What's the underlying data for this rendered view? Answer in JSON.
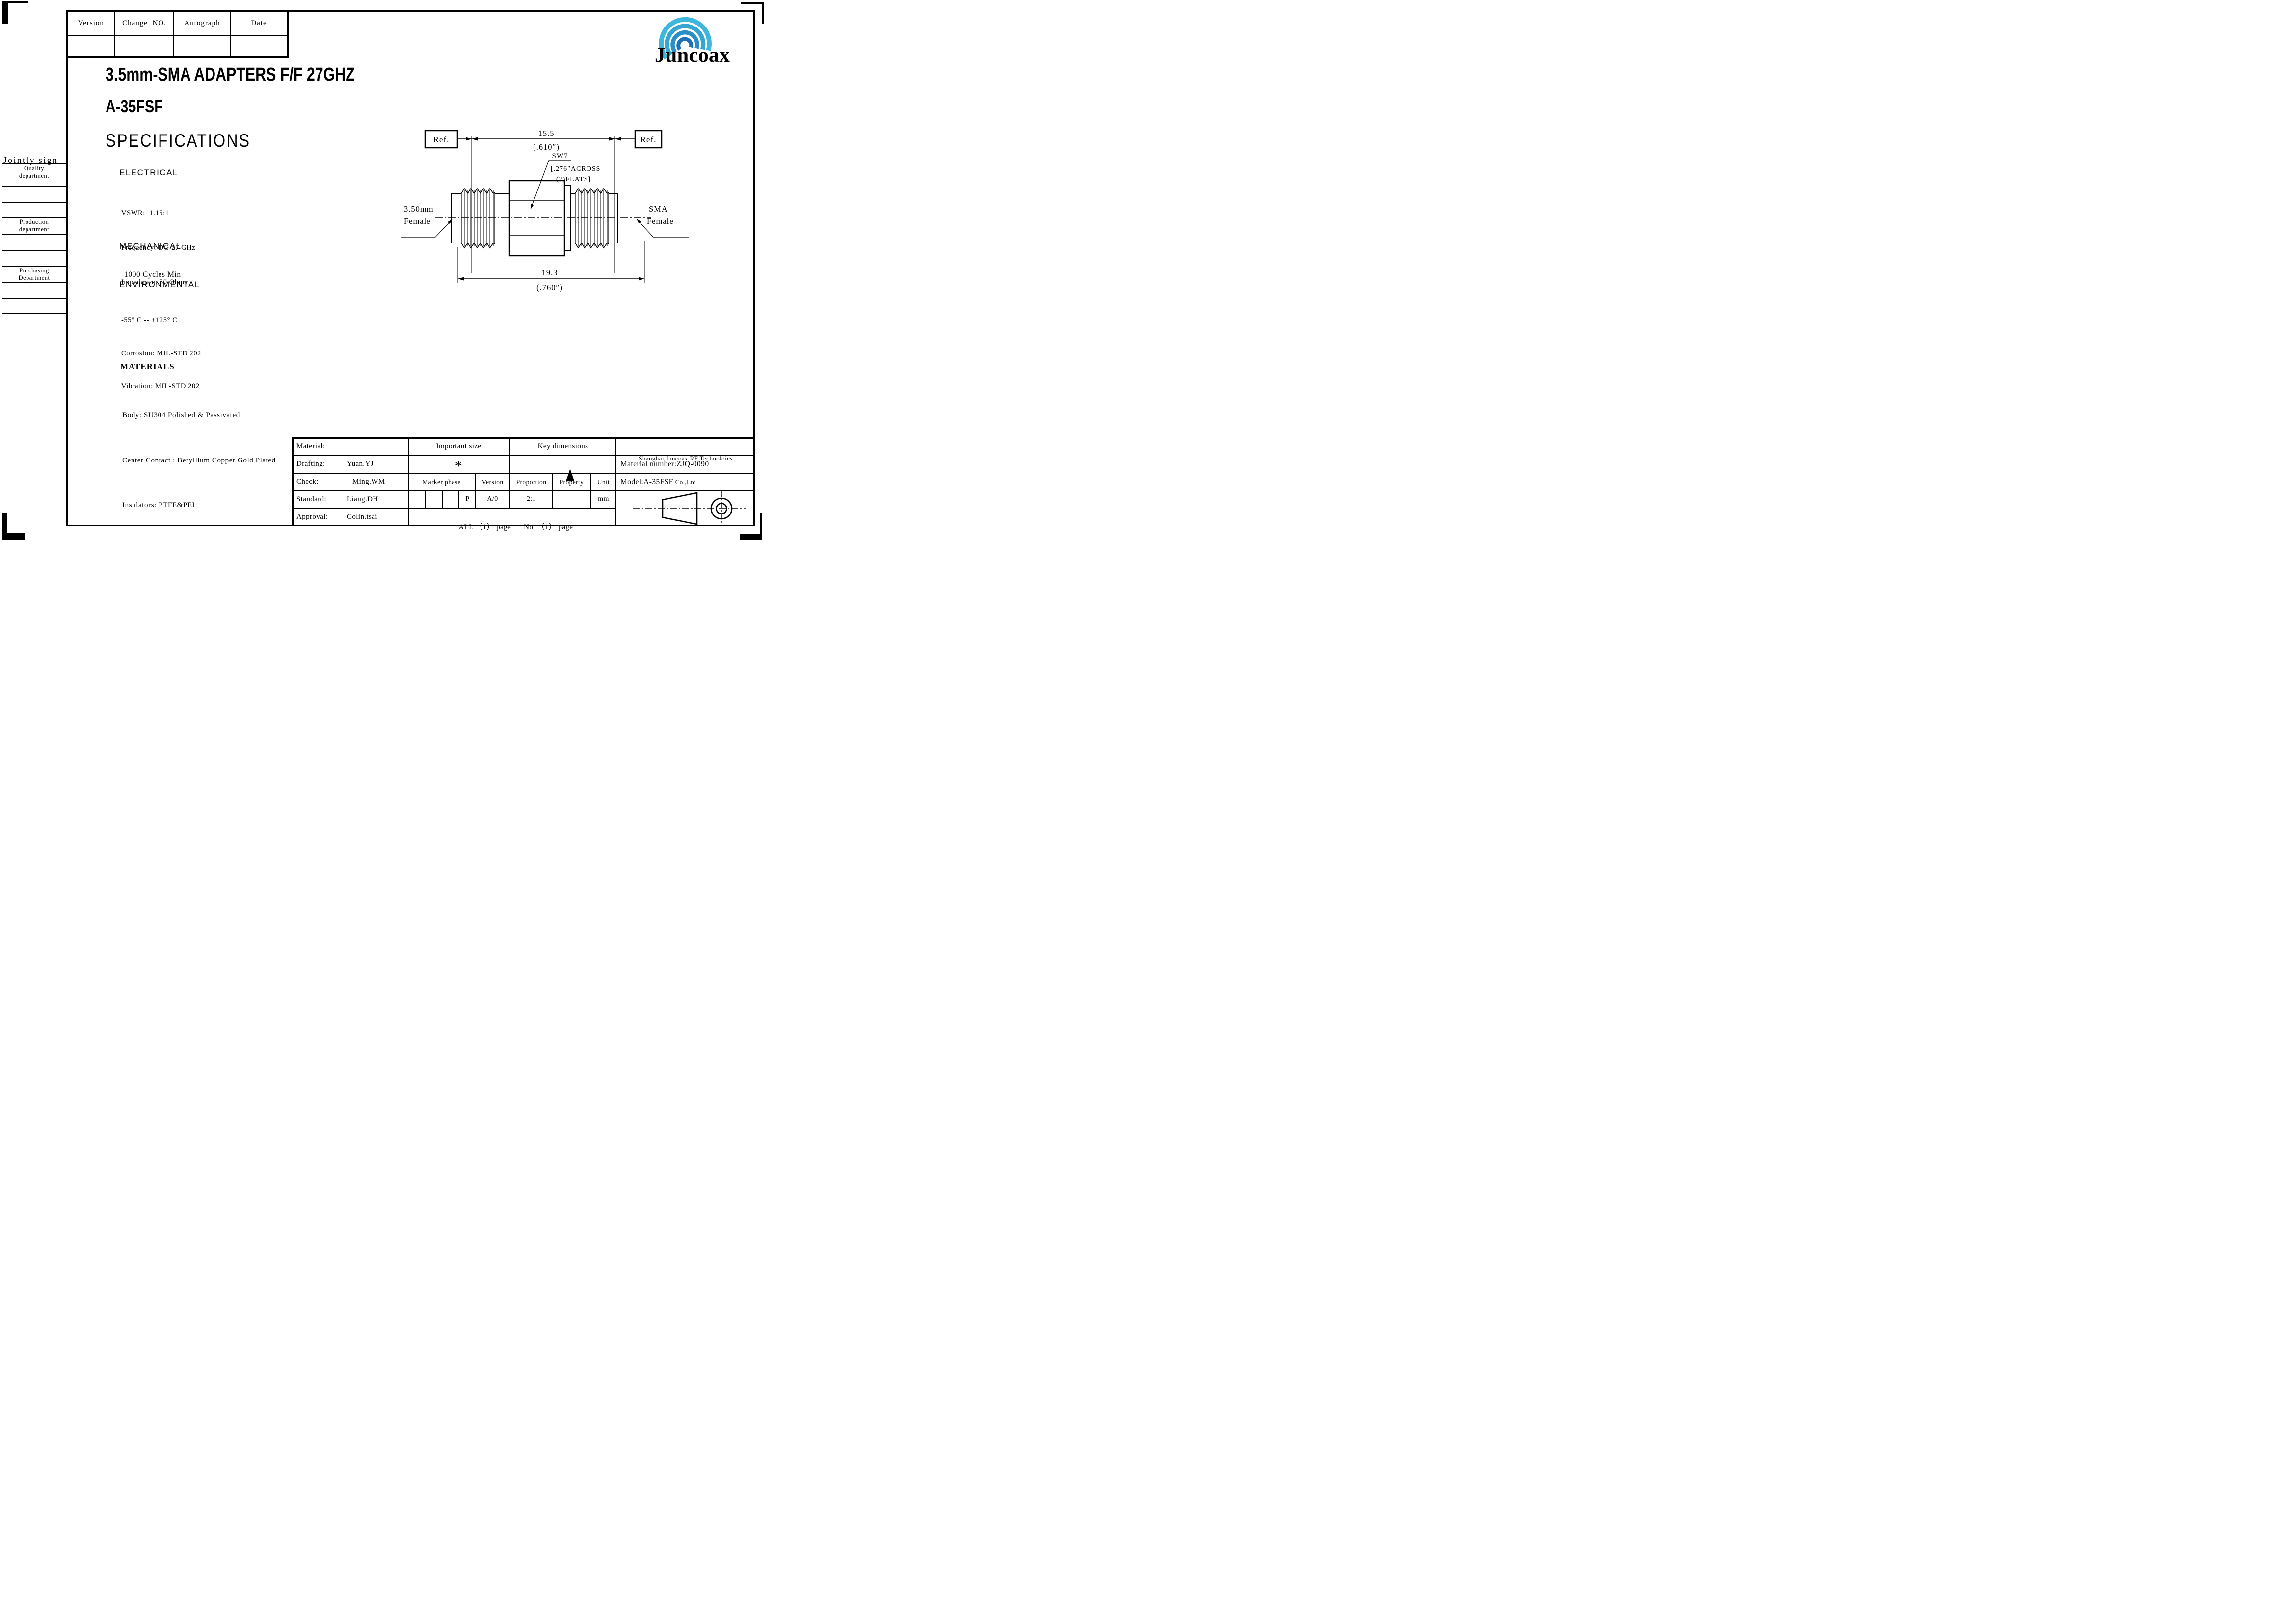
{
  "colors": {
    "logo_blue": "#1b67b8",
    "logo_teal_outer": "#3fb7dc",
    "ink": "#000000"
  },
  "revision_table": {
    "headers": [
      "Version",
      "Change  NO.",
      "Autograph",
      "Date"
    ]
  },
  "logo": {
    "text": "Juncoax"
  },
  "titles": {
    "product": "3.5mm-SMA ADAPTERS F/F 27GHZ",
    "model": "A-35FSF",
    "section": "SPECIFICATIONS"
  },
  "jointly_sign": {
    "title": "Jointly sign",
    "quality_line1": "Quality",
    "quality_line2": "department",
    "production_line1": "Production",
    "production_line2": "department",
    "purchasing_line1": "Purchasing",
    "purchasing_line2": "Department"
  },
  "specs": {
    "electrical": {
      "heading": "ELECTRICAL",
      "lines": [
        "VSWR:  1.15:1",
        "Frequency: DC-27 GHz",
        "Impedance: 50 Ohms"
      ]
    },
    "mechanical": {
      "heading": "MECHANICAL",
      "lines": [
        "1000 Cycles Min"
      ]
    },
    "environmental": {
      "heading": "ENVIRONMENTAL",
      "lines": [
        "-55° C -- +125° C",
        "Corrosion: MIL-STD 202",
        "Vibration: MIL-STD 202"
      ]
    },
    "materials": {
      "heading": "MATERIALS",
      "lines": [
        "Body: SU304 Polished & Passivated",
        "Center Contact : Beryllium Copper Gold Plated",
        "Insulators: PTFE&PEI"
      ]
    }
  },
  "drawing": {
    "ref_left": "Ref.",
    "ref_right": "Ref.",
    "dim_body": {
      "value": "15.5",
      "inches": "(.610″)"
    },
    "dim_overall": {
      "value": "19.3",
      "inches": "(.760″)"
    },
    "wrench": {
      "label": "SW7",
      "note1": "[.276″ACROSS",
      "note2": "(2)FLATS]"
    },
    "left_port": {
      "line1": "3.50mm",
      "line2": "Female"
    },
    "right_port": {
      "line1": "SMA",
      "line2": "Female"
    }
  },
  "title_block": {
    "material_label": "Material:",
    "drafting_label": "Drafting:",
    "drafting_value": "Yuan.YJ",
    "check_label": "Check:",
    "check_value": "Ming.WM",
    "standard_label": "Standard:",
    "standard_value": "Liang.DH",
    "approval_label": "Approval:",
    "approval_value": "Colin.tsai",
    "important_size": "Important size",
    "important_size_symbol": "*",
    "key_dimensions": "Key dimensions",
    "key_dimensions_symbol": "▲",
    "marker_phase": "Marker phase",
    "version": "Version",
    "proportion": "Proportion",
    "property": "Property",
    "unit": "Unit",
    "marker_value": "P",
    "version_value": "A/0",
    "proportion_value": "2:1",
    "property_value": "",
    "unit_value": "mm",
    "pages_all": "ALL （1） page",
    "pages_no": "No. （1） page",
    "company_line1": "Shanghai Juncoax RF Technoloies",
    "company_line2": "Co.,Ltd",
    "material_number": "Material number:ZJQ-0090",
    "model": "Model:A-35FSF"
  }
}
